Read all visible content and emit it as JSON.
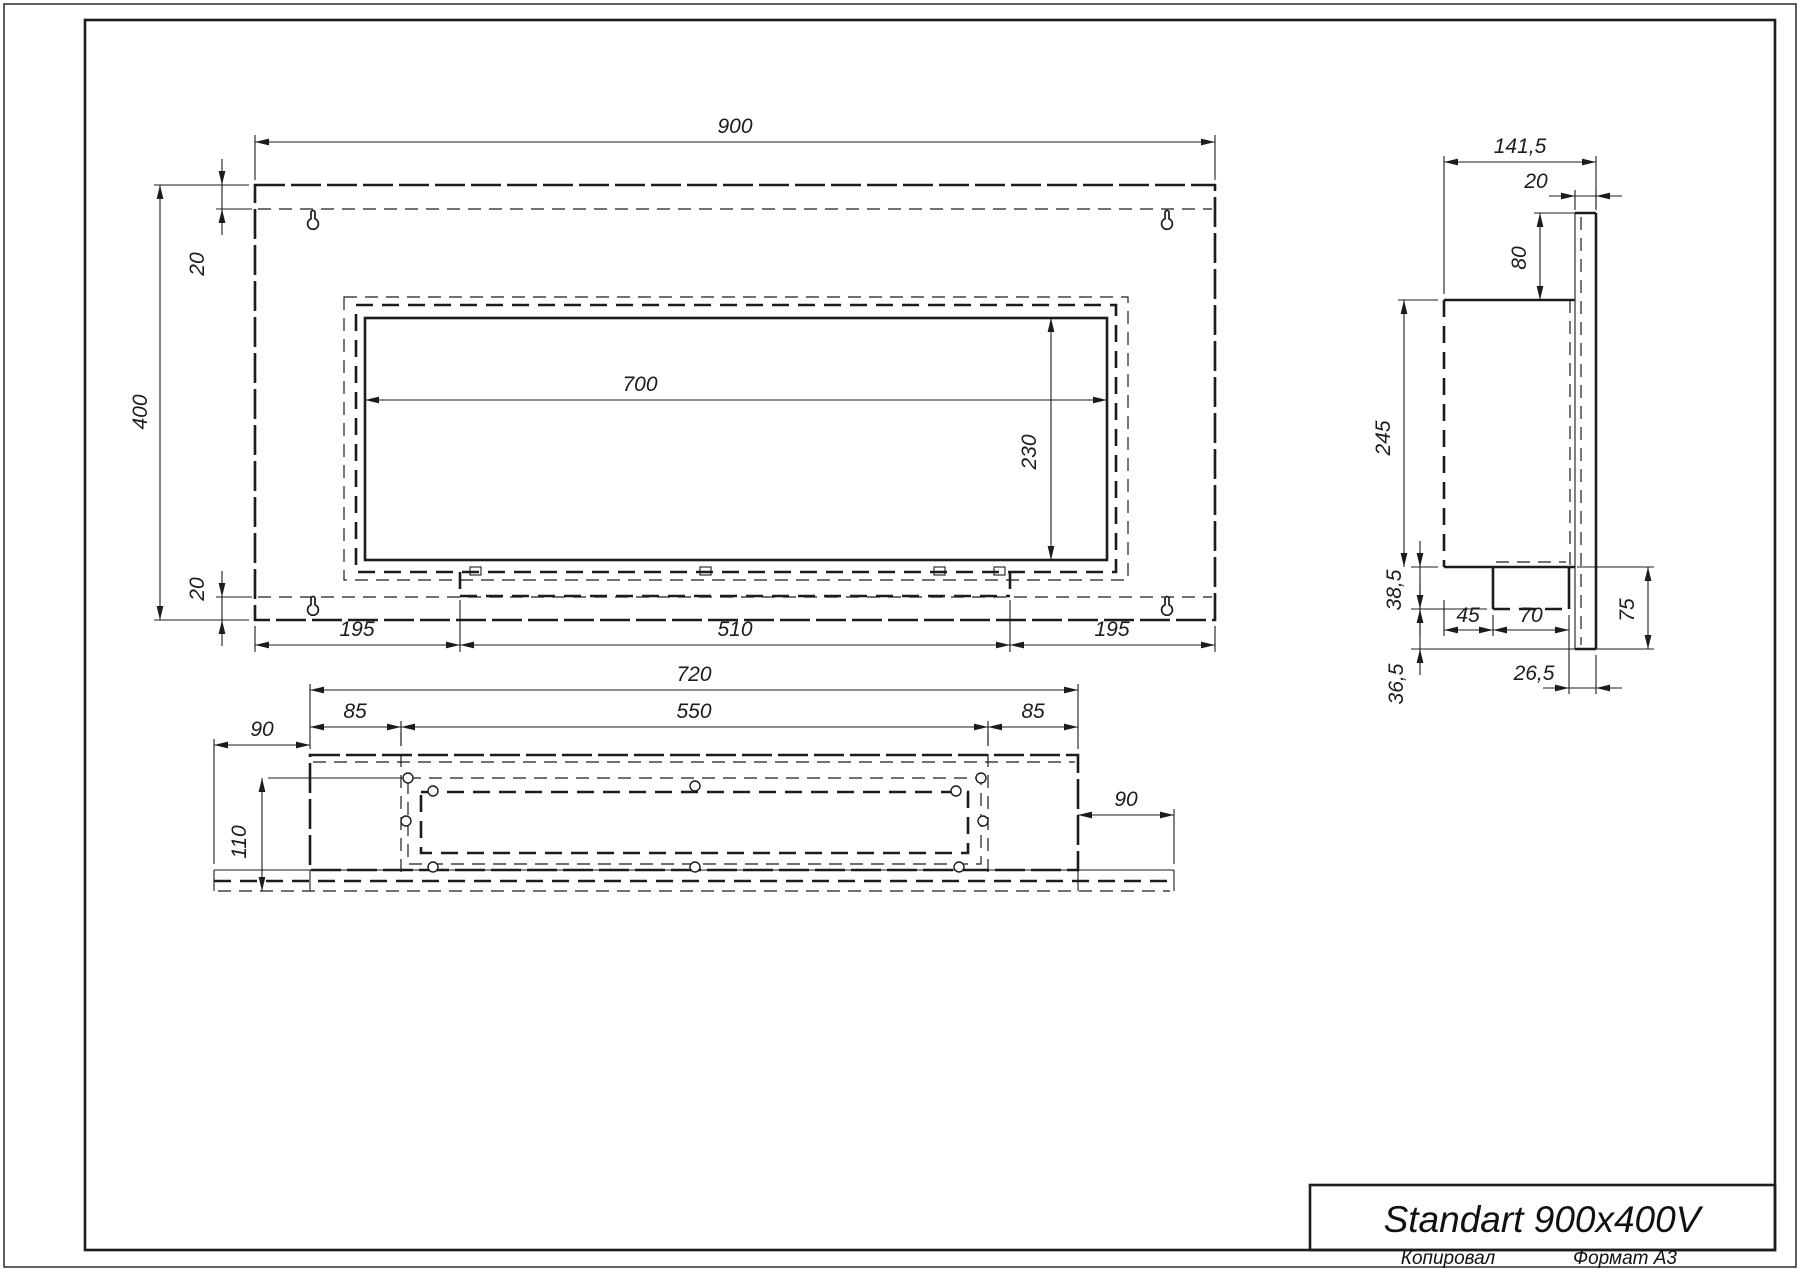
{
  "sheet": {
    "title": "Standart 900x400V",
    "copied_label": "Копировал",
    "format_label": "Формат А3",
    "line_color": "#1c1c1c",
    "background": "#ffffff"
  },
  "views": {
    "front_view_dims": [
      "900",
      "400",
      "20",
      "20",
      "700",
      "230",
      "195",
      "510",
      "195"
    ],
    "side_view_dims": [
      "141,5",
      "20",
      "80",
      "245",
      "38,5",
      "36,5",
      "45",
      "70",
      "26,5",
      "75"
    ],
    "bottom_view_dims": [
      "720",
      "85",
      "550",
      "85",
      "90",
      "110",
      "90"
    ]
  },
  "geometry": {
    "thin": [
      [
        255,
        180,
        255,
        135
      ],
      [
        1215,
        180,
        1215,
        135
      ],
      [
        249,
        185,
        154,
        185
      ],
      [
        249,
        620,
        154,
        620
      ],
      [
        252,
        209,
        216,
        209
      ],
      [
        252,
        597,
        216,
        597
      ],
      [
        255,
        626,
        255,
        652
      ],
      [
        460,
        600,
        460,
        652
      ],
      [
        1010,
        600,
        1010,
        652
      ],
      [
        1215,
        626,
        1215,
        652
      ],
      [
        1444,
        294,
        1444,
        156
      ],
      [
        1596,
        207,
        1596,
        156
      ],
      [
        1575,
        210,
        1575,
        190
      ],
      [
        1596,
        210,
        1596,
        190
      ],
      [
        1575,
        213,
        1534,
        213
      ],
      [
        1438,
        300,
        1398,
        300
      ],
      [
        1438,
        567,
        1411,
        567
      ],
      [
        1438,
        300,
        1398,
        300
      ],
      [
        1487,
        609,
        1411,
        609
      ],
      [
        1575,
        649,
        1411,
        649
      ],
      [
        1444,
        600,
        1444,
        636
      ],
      [
        1493,
        615,
        1493,
        636
      ],
      [
        1569,
        615,
        1569,
        636
      ],
      [
        1569,
        636,
        1569,
        694
      ],
      [
        1596,
        655,
        1596,
        694
      ],
      [
        1577,
        567,
        1654,
        567
      ],
      [
        1596,
        649,
        1654,
        649
      ],
      [
        1575,
        213,
        1575,
        649
      ],
      [
        310,
        749,
        310,
        684
      ],
      [
        1078,
        749,
        1078,
        684
      ],
      [
        401,
        721,
        401,
        734
      ],
      [
        988,
        721,
        988,
        734
      ],
      [
        214,
        864,
        214,
        739
      ],
      [
        268,
        778,
        410,
        778
      ],
      [
        1174,
        864,
        1174,
        809
      ],
      [
        214,
        870,
        1174,
        870
      ],
      [
        214,
        870,
        214,
        891
      ],
      [
        1174,
        870,
        1174,
        891
      ],
      [
        310,
        870,
        310,
        891
      ],
      [
        1078,
        870,
        1078,
        891
      ]
    ],
    "thick": [
      [
        1575,
        213,
        1596,
        213
      ],
      [
        1596,
        213,
        1596,
        649
      ],
      [
        1575,
        649,
        1596,
        649
      ],
      [
        1444,
        300,
        1575,
        300
      ],
      [
        1444,
        567,
        1575,
        567
      ],
      [
        1493,
        567,
        1493,
        609
      ],
      [
        1569,
        567,
        1569,
        609
      ]
    ],
    "dash_thick": [
      [
        460,
        572,
        460,
        596
      ],
      [
        1010,
        572,
        1010,
        596
      ],
      [
        460,
        596,
        1010,
        596
      ],
      [
        1444,
        300,
        1444,
        567
      ],
      [
        1493,
        609,
        1569,
        609
      ],
      [
        214,
        881,
        1174,
        881
      ]
    ],
    "dash_thin": [
      [
        258,
        209,
        1212,
        209
      ],
      [
        258,
        597,
        1212,
        597
      ],
      [
        1581,
        217,
        1581,
        645
      ],
      [
        1570,
        300,
        1570,
        567
      ],
      [
        1496,
        562,
        1566,
        562
      ],
      [
        313,
        762,
        1075,
        762
      ],
      [
        401,
        733,
        401,
        875
      ],
      [
        988,
        733,
        988,
        875
      ],
      [
        218,
        891,
        1170,
        891
      ]
    ],
    "rect_thick": [
      [
        365,
        318,
        742,
        242
      ]
    ],
    "rect_thick_longdash": [
      [
        255,
        185,
        960,
        435
      ],
      [
        310,
        755,
        768,
        115
      ]
    ],
    "rect_dash_thick": [
      [
        356,
        305,
        760,
        267
      ],
      [
        421,
        792,
        547,
        61
      ]
    ],
    "rect_dash_thin": [
      [
        344,
        297,
        784,
        283
      ],
      [
        408,
        778,
        573,
        86
      ]
    ],
    "small_rects": [
      [
        470,
        567,
        11,
        8
      ],
      [
        700,
        567,
        11,
        8
      ],
      [
        934,
        567,
        11,
        8
      ],
      [
        994,
        567,
        11,
        8
      ]
    ],
    "holes": [
      [
        408,
        778
      ],
      [
        981,
        778
      ],
      [
        433,
        791
      ],
      [
        956,
        791
      ],
      [
        695,
        786
      ],
      [
        406,
        821
      ],
      [
        983,
        821
      ],
      [
        433,
        867
      ],
      [
        695,
        867
      ],
      [
        959,
        867
      ]
    ],
    "keyholes": [
      [
        313,
        223
      ],
      [
        1167,
        223
      ],
      [
        313,
        609
      ],
      [
        1167,
        609
      ]
    ],
    "dims": [
      [
        255,
        142,
        1215,
        142,
        0
      ],
      [
        160,
        185,
        160,
        620,
        0
      ],
      [
        222,
        185,
        222,
        209,
        1
      ],
      [
        222,
        597,
        222,
        620,
        1
      ],
      [
        365,
        400,
        1107,
        400,
        0
      ],
      [
        1051,
        318,
        1051,
        560,
        0
      ],
      [
        255,
        645,
        460,
        645,
        0
      ],
      [
        460,
        645,
        1010,
        645,
        0
      ],
      [
        1010,
        645,
        1215,
        645,
        0
      ],
      [
        1444,
        162,
        1596,
        162,
        0
      ],
      [
        1575,
        196,
        1596,
        196,
        1
      ],
      [
        1540,
        213,
        1540,
        300,
        0
      ],
      [
        1404,
        300,
        1404,
        567,
        0
      ],
      [
        1420,
        567,
        1420,
        609,
        1
      ],
      [
        1420,
        609,
        1420,
        649,
        1
      ],
      [
        1444,
        630,
        1493,
        630,
        0
      ],
      [
        1493,
        630,
        1569,
        630,
        0
      ],
      [
        1569,
        688,
        1596,
        688,
        1
      ],
      [
        1648,
        567,
        1648,
        649,
        0
      ],
      [
        310,
        690,
        1078,
        690,
        0
      ],
      [
        310,
        727,
        401,
        727,
        0
      ],
      [
        401,
        727,
        988,
        727,
        0
      ],
      [
        988,
        727,
        1078,
        727,
        0
      ],
      [
        214,
        745,
        310,
        745,
        0
      ],
      [
        262,
        778,
        262,
        891,
        0
      ],
      [
        1078,
        815,
        1174,
        815,
        0
      ]
    ],
    "labels": [
      {
        "t": "900",
        "x": 735,
        "y": 133,
        "r": 0
      },
      {
        "t": "400",
        "x": 147,
        "y": 412,
        "r": -90
      },
      {
        "t": "20",
        "x": 204,
        "y": 264,
        "r": -90
      },
      {
        "t": "20",
        "x": 204,
        "y": 589,
        "r": -90
      },
      {
        "t": "700",
        "x": 640,
        "y": 391,
        "r": 0
      },
      {
        "t": "230",
        "x": 1036,
        "y": 452,
        "r": -90
      },
      {
        "t": "195",
        "x": 357,
        "y": 636,
        "r": 0
      },
      {
        "t": "510",
        "x": 735,
        "y": 636,
        "r": 0
      },
      {
        "t": "195",
        "x": 1112,
        "y": 636,
        "r": 0
      },
      {
        "t": "141,5",
        "x": 1520,
        "y": 153,
        "r": 0
      },
      {
        "t": "20",
        "x": 1536,
        "y": 188,
        "r": 0
      },
      {
        "t": "80",
        "x": 1526,
        "y": 258,
        "r": -90
      },
      {
        "t": "245",
        "x": 1390,
        "y": 438,
        "r": -90
      },
      {
        "t": "38,5",
        "x": 1401,
        "y": 590,
        "r": -90
      },
      {
        "t": "36,5",
        "x": 1403,
        "y": 684,
        "r": -90
      },
      {
        "t": "45",
        "x": 1468,
        "y": 622,
        "r": 0
      },
      {
        "t": "70",
        "x": 1531,
        "y": 622,
        "r": 0
      },
      {
        "t": "26,5",
        "x": 1534,
        "y": 680,
        "r": 0
      },
      {
        "t": "75",
        "x": 1634,
        "y": 610,
        "r": -90
      },
      {
        "t": "720",
        "x": 694,
        "y": 681,
        "r": 0
      },
      {
        "t": "85",
        "x": 355,
        "y": 718,
        "r": 0
      },
      {
        "t": "550",
        "x": 694,
        "y": 718,
        "r": 0
      },
      {
        "t": "85",
        "x": 1033,
        "y": 718,
        "r": 0
      },
      {
        "t": "90",
        "x": 262,
        "y": 736,
        "r": 0
      },
      {
        "t": "110",
        "x": 246,
        "y": 842,
        "r": -90
      },
      {
        "t": "90",
        "x": 1126,
        "y": 806,
        "r": 0
      }
    ]
  }
}
